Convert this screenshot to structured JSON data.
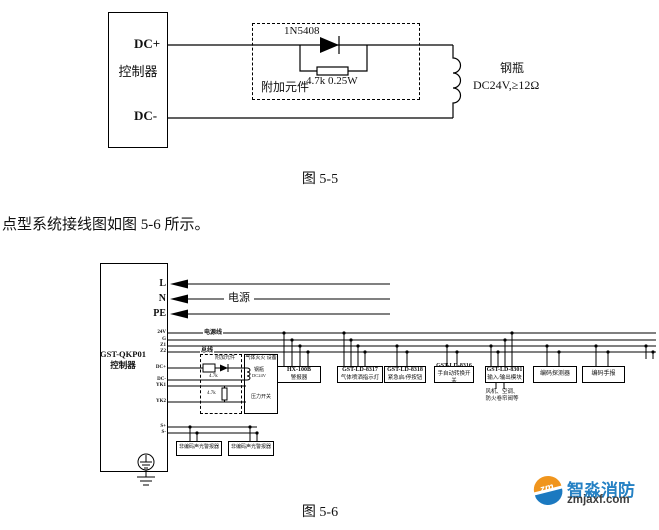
{
  "fig55": {
    "caption": "图 5-5",
    "controller": "控制器",
    "terminal_dc_plus": "DC+",
    "terminal_dc_minus": "DC-",
    "diode": "1N5408",
    "resistor": "4.7k 0.25W",
    "dashed_box_label": "附加元件",
    "load_name": "钢瓶",
    "load_spec": "DC24V,≥12Ω"
  },
  "paragraph": "点型系统接线图如图 5-6 所示。",
  "fig56": {
    "caption": "图 5-6",
    "controller_model": "GST-QKP01",
    "controller_label": "控制器",
    "power_terminals": [
      "L",
      "N",
      "PE"
    ],
    "power_label": "电源",
    "bus_terminals": [
      "24V",
      "G",
      "Z1",
      "Z2"
    ],
    "power_line_label": "电源线",
    "bus_line_label": "总线",
    "out_terminals": [
      "DC+",
      "DC-",
      "YK1",
      "YK2"
    ],
    "sound_terminals": [
      "S+",
      "S-"
    ],
    "addon_box": {
      "label": "附加元件",
      "r1": "4.7k",
      "r2": "4.7k"
    },
    "gas_box": {
      "label": "气体灭火 设备",
      "cylinder": "钢瓶",
      "cylinder_spec": "DC24V",
      "switch": "压力开关"
    },
    "devices": [
      {
        "model": "HX-100B",
        "name": "警报器"
      },
      {
        "model": "GST-LD-8317",
        "name": "气体喷洒指示灯"
      },
      {
        "model": "GST-LD-8318",
        "name": "紧急启/停按钮"
      },
      {
        "model": "GST-LD-8316",
        "name": "手自动转换开关"
      },
      {
        "model": "GST-LD-8301",
        "name": "输入/输出模块"
      }
    ],
    "detector_label": "编码探测器",
    "callpoint_label": "编码手报",
    "module_note_line1": "风机、空调、",
    "module_note_line2": "防火卷帘阀等",
    "alarm_boxes": [
      "非编码声光警报器",
      "非编码声光警报器"
    ]
  },
  "watermark": {
    "icon_text": "zm",
    "brand": "智淼消防",
    "domain": "zmjaxf.com",
    "brand_color": "#2581c4",
    "orange": "#f0951d",
    "blue": "#1b79c0"
  }
}
